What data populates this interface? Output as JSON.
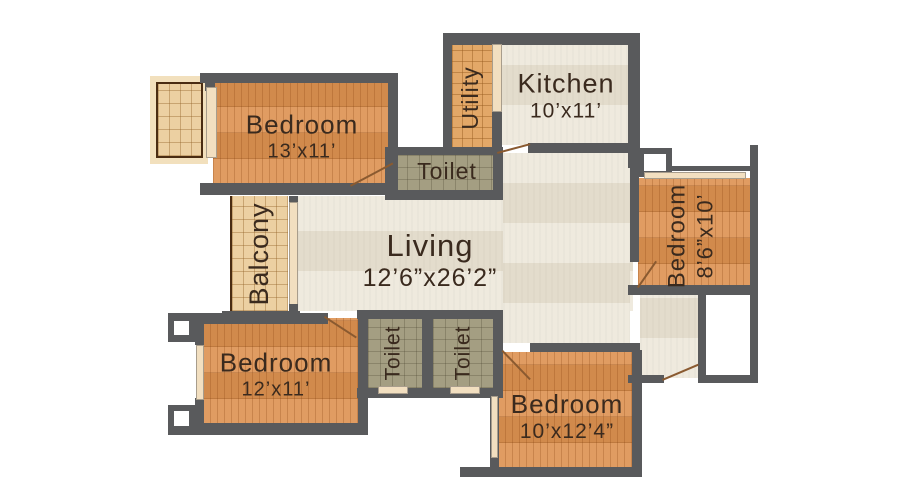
{
  "plan": {
    "colors": {
      "background": "#ffffff",
      "wall": "#595a5c",
      "parquet": "#dc9150",
      "tile_tan": "#ecd0a2",
      "tile_utility": "#e3a868",
      "tile_olive": "#a49e82",
      "floor_living": "#eae3d3",
      "door_cream": "#f2dfc0",
      "door_leaf": "#8a5a30",
      "patio_border": "#4a2c12",
      "text": "#3a2a1e"
    },
    "rooms": {
      "bedroom_top_left": {
        "label": "Bedroom",
        "dims": "13’x11’"
      },
      "utility": {
        "label": "Utility"
      },
      "kitchen": {
        "label": "Kitchen",
        "dims": "10’x11’"
      },
      "toilet_top": {
        "label": "Toilet"
      },
      "balcony": {
        "label": "Balcony"
      },
      "living": {
        "label": "Living",
        "dims": "12’6”x26’2”"
      },
      "bedroom_right": {
        "label": "Bedroom",
        "dims": "8’6”x10’"
      },
      "bedroom_bottom_left": {
        "label": "Bedroom",
        "dims": "12’x11’"
      },
      "toilet_bottom_left": {
        "label": "Toilet"
      },
      "toilet_bottom_right": {
        "label": "Toilet"
      },
      "bedroom_bottom_right": {
        "label": "Bedroom",
        "dims": "10’x12’4”"
      }
    }
  }
}
